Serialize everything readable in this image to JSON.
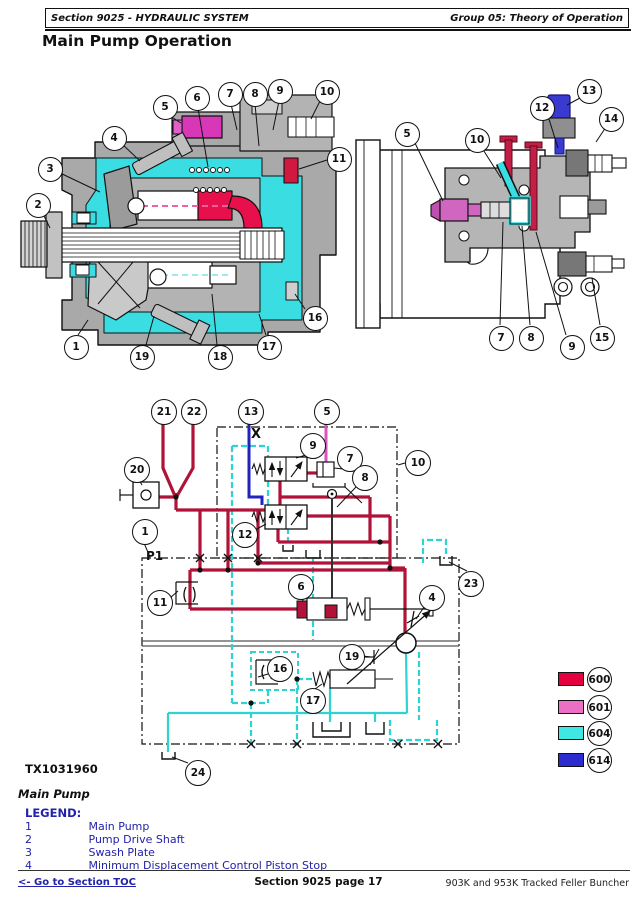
{
  "header": {
    "left": "Section 9025 - HYDRAULIC SYSTEM",
    "right": "Group 05: Theory of Operation"
  },
  "title": "Main Pump Operation",
  "figure": {
    "id": "TX1031960",
    "caption": "Main Pump"
  },
  "legend": {
    "heading": "LEGEND:",
    "items": [
      {
        "num": "1",
        "label": "Main Pump"
      },
      {
        "num": "2",
        "label": "Pump Drive Shaft"
      },
      {
        "num": "3",
        "label": "Swash Plate"
      },
      {
        "num": "4",
        "label": "Minimum Displacement Control Piston Stop"
      }
    ]
  },
  "color_legend": [
    {
      "code": "600",
      "hex": "#E4003E"
    },
    {
      "code": "601",
      "hex": "#ED6FC4"
    },
    {
      "code": "604",
      "hex": "#40E8E4"
    },
    {
      "code": "614",
      "hex": "#2B2BD0"
    }
  ],
  "schematic": {
    "x_label": "X",
    "p1_label": "P1"
  },
  "callouts": {
    "left": [
      "1",
      "2",
      "3",
      "4",
      "5",
      "6",
      "7",
      "8",
      "9",
      "10",
      "11",
      "16",
      "17",
      "18",
      "19"
    ],
    "right": [
      "5",
      "7",
      "8",
      "9",
      "10",
      "12",
      "13",
      "14",
      "15"
    ],
    "schematic": [
      "1",
      "4",
      "5",
      "6",
      "7",
      "8",
      "9",
      "10",
      "11",
      "12",
      "13",
      "16",
      "17",
      "19",
      "20",
      "21",
      "22",
      "23",
      "24"
    ]
  },
  "footer": {
    "left": "<- Go to Section TOC",
    "center": "Section 9025 page 17",
    "right": "903K and 953K Tracked Feller Buncher"
  }
}
